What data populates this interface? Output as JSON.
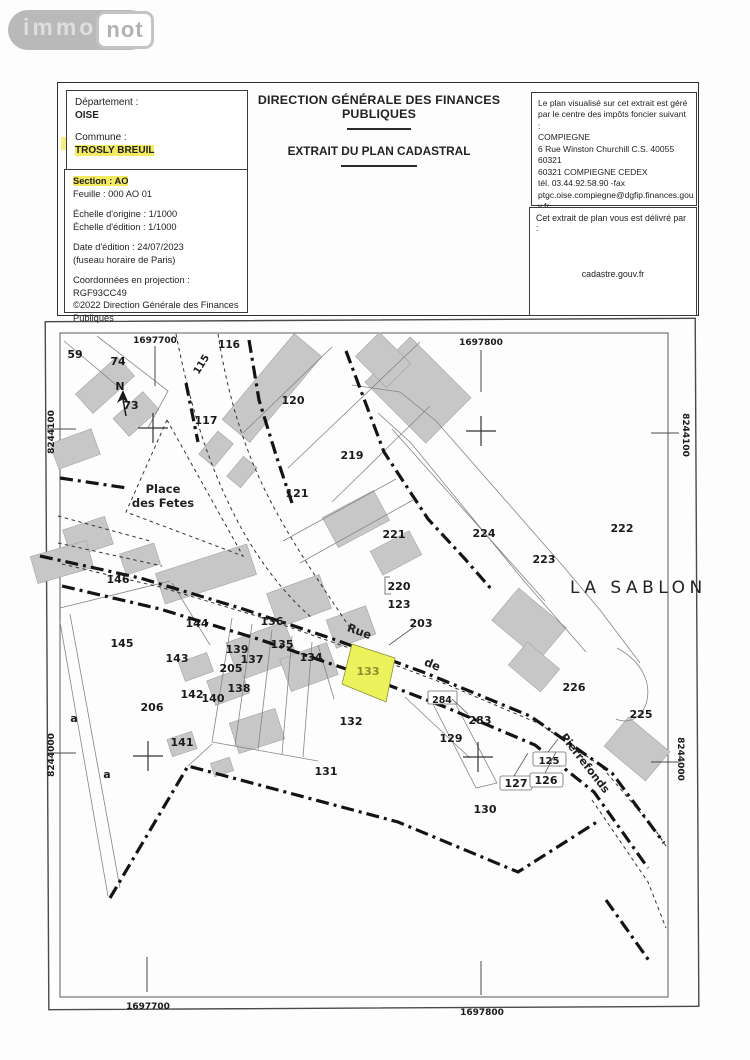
{
  "logo": {
    "immo": "immo",
    "not": "not"
  },
  "header": {
    "title1": "DIRECTION GÉNÉRALE DES FINANCES PUBLIQUES",
    "title2": "EXTRAIT DU PLAN CADASTRAL",
    "left_box1": {
      "departement_label": "Département :",
      "departement": "OISE",
      "commune_label": "Commune :",
      "commune": "TROSLY BREUIL"
    },
    "left_box2": {
      "section": "Section : AO",
      "feuille": "Feuille : 000 AO 01",
      "echelle_origine": "Échelle d'origine : 1/1000",
      "echelle_edition": "Échelle d'édition : 1/1000",
      "date_edition": "Date d'édition : 24/07/2023",
      "fuseau": "(fuseau horaire de Paris)",
      "coordonnees": "Coordonnées en projection : RGF93CC49",
      "copyright1": "©2022 Direction Générale des Finances",
      "copyright2": "Publiques"
    },
    "right_box1": {
      "lines": [
        "Le plan visualisé sur cet extrait est géré",
        "par le centre des impôts foncier suivant :",
        "COMPIEGNE",
        "6 Rue Winston Churchill C.S. 40055",
        "60321",
        "60321 COMPIEGNE CEDEX",
        "tél. 03.44.92.58.90 -fax",
        "ptgc.oise.compiegne@dgfip.finances.gou",
        "v.fr"
      ]
    },
    "right_box2": {
      "intro": "Cet extrait de plan vous est délivré par :",
      "site": "cadastre.gouv.fr"
    }
  },
  "map": {
    "colors": {
      "highlight_parcel_fill": "#eaf25c",
      "highlight_parcel_label": "#8c8c2e",
      "building_gray": "#c7c7c7",
      "marker_yellow": "#f3ea5f"
    },
    "north_label": "N",
    "grid": {
      "top": [
        {
          "label": "1697700",
          "x": 155,
          "y": 340,
          "tick": [
            155,
            346,
            155,
            386
          ]
        },
        {
          "label": "1697800",
          "x": 481,
          "y": 342,
          "tick": [
            481,
            350,
            481,
            392
          ]
        }
      ],
      "bottom": [
        {
          "label": "1697700",
          "x": 148,
          "y": 1006,
          "tick": [
            147,
            957,
            147,
            992
          ]
        },
        {
          "label": "1697800",
          "x": 482,
          "y": 1012,
          "tick": [
            481,
            961,
            481,
            995
          ]
        }
      ],
      "left": [
        {
          "label": "8244100",
          "x": 54,
          "y": 429,
          "rot": -90,
          "tick": [
            47,
            429,
            76,
            429
          ]
        },
        {
          "label": "8244000",
          "x": 54,
          "y": 752,
          "rot": -90,
          "tick": [
            47,
            753,
            76,
            753
          ]
        }
      ],
      "right": [
        {
          "label": "8244100",
          "x": 683,
          "y": 432,
          "rot": 90,
          "tick": [
            651,
            433,
            679,
            433
          ]
        },
        {
          "label": "8244000",
          "x": 678,
          "y": 756,
          "rot": 90,
          "tick": [
            651,
            762,
            679,
            762
          ]
        }
      ]
    },
    "crosses": [
      {
        "x": 153,
        "y": 428
      },
      {
        "x": 481,
        "y": 431
      },
      {
        "x": 148,
        "y": 756
      },
      {
        "x": 478,
        "y": 757
      }
    ],
    "highlighted_parcel": {
      "number": "133",
      "points": "352,644 395,658 386,702 342,684"
    },
    "parcels": [
      {
        "n": "59",
        "x": 75,
        "y": 354
      },
      {
        "n": "74",
        "x": 118,
        "y": 361
      },
      {
        "n": "73",
        "x": 131,
        "y": 405
      },
      {
        "n": "115",
        "x": 204,
        "y": 362,
        "rot": -58,
        "size": 10
      },
      {
        "n": "116",
        "x": 229,
        "y": 344,
        "size": 10.5
      },
      {
        "n": "117",
        "x": 206,
        "y": 420
      },
      {
        "n": "120",
        "x": 293,
        "y": 400
      },
      {
        "n": "219",
        "x": 352,
        "y": 455
      },
      {
        "n": "121",
        "x": 297,
        "y": 493
      },
      {
        "n": "221",
        "x": 394,
        "y": 534
      },
      {
        "n": "224",
        "x": 484,
        "y": 533
      },
      {
        "n": "223",
        "x": 544,
        "y": 559
      },
      {
        "n": "222",
        "x": 622,
        "y": 528
      },
      {
        "n": "146",
        "x": 118,
        "y": 579
      },
      {
        "n": "145",
        "x": 122,
        "y": 643
      },
      {
        "n": "144",
        "x": 197,
        "y": 623
      },
      {
        "n": "143",
        "x": 177,
        "y": 658
      },
      {
        "n": "136",
        "x": 272,
        "y": 621
      },
      {
        "n": "139",
        "x": 237,
        "y": 649
      },
      {
        "n": "137",
        "x": 252,
        "y": 659
      },
      {
        "n": "135",
        "x": 282,
        "y": 644
      },
      {
        "n": "134",
        "x": 311,
        "y": 657
      },
      {
        "n": "205",
        "x": 231,
        "y": 668
      },
      {
        "n": "138",
        "x": 239,
        "y": 688
      },
      {
        "n": "142",
        "x": 192,
        "y": 694
      },
      {
        "n": "140",
        "x": 213,
        "y": 698
      },
      {
        "n": "206",
        "x": 152,
        "y": 707
      },
      {
        "n": "141",
        "x": 182,
        "y": 742
      },
      {
        "n": "133",
        "x": 368,
        "y": 671,
        "color": "#8c8c2e"
      },
      {
        "n": "132",
        "x": 351,
        "y": 721
      },
      {
        "n": "131",
        "x": 326,
        "y": 771
      },
      {
        "n": "220",
        "x": 399,
        "y": 586
      },
      {
        "n": "123",
        "x": 399,
        "y": 604
      },
      {
        "n": "203",
        "x": 421,
        "y": 623
      },
      {
        "n": "226",
        "x": 574,
        "y": 687
      },
      {
        "n": "225",
        "x": 641,
        "y": 714
      },
      {
        "n": "284",
        "x": 442,
        "y": 699,
        "size": 9.5
      },
      {
        "n": "283",
        "x": 480,
        "y": 720
      },
      {
        "n": "129",
        "x": 451,
        "y": 738
      },
      {
        "n": "125",
        "x": 549,
        "y": 760,
        "size": 10
      },
      {
        "n": "127",
        "x": 516,
        "y": 783
      },
      {
        "n": "126",
        "x": 546,
        "y": 780
      },
      {
        "n": "130",
        "x": 485,
        "y": 809
      },
      {
        "n": "a",
        "x": 74,
        "y": 718
      },
      {
        "n": "a",
        "x": 107,
        "y": 774
      }
    ],
    "street_names": [
      {
        "text": "Rue",
        "x": 358,
        "y": 635,
        "rot": 20,
        "size": 11.5,
        "weight": 700
      },
      {
        "text": "de",
        "x": 431,
        "y": 668,
        "rot": 22,
        "size": 11.5,
        "weight": 700
      },
      {
        "text": "Pierrefonds",
        "x": 560,
        "y": 737,
        "rot": 52,
        "size": 11,
        "weight": 700,
        "anchor": "start"
      },
      {
        "text": "Place",
        "x": 163,
        "y": 493,
        "rot": 0,
        "size": 11.5,
        "weight": 700
      },
      {
        "text": "des Fetes",
        "x": 163,
        "y": 507,
        "rot": 0,
        "size": 11.5,
        "weight": 700
      },
      {
        "text": "LA SABLON",
        "x": 570,
        "y": 593,
        "rot": 0,
        "size": 17,
        "weight": 400,
        "anchor": "start",
        "spacing": 4.5
      }
    ]
  }
}
